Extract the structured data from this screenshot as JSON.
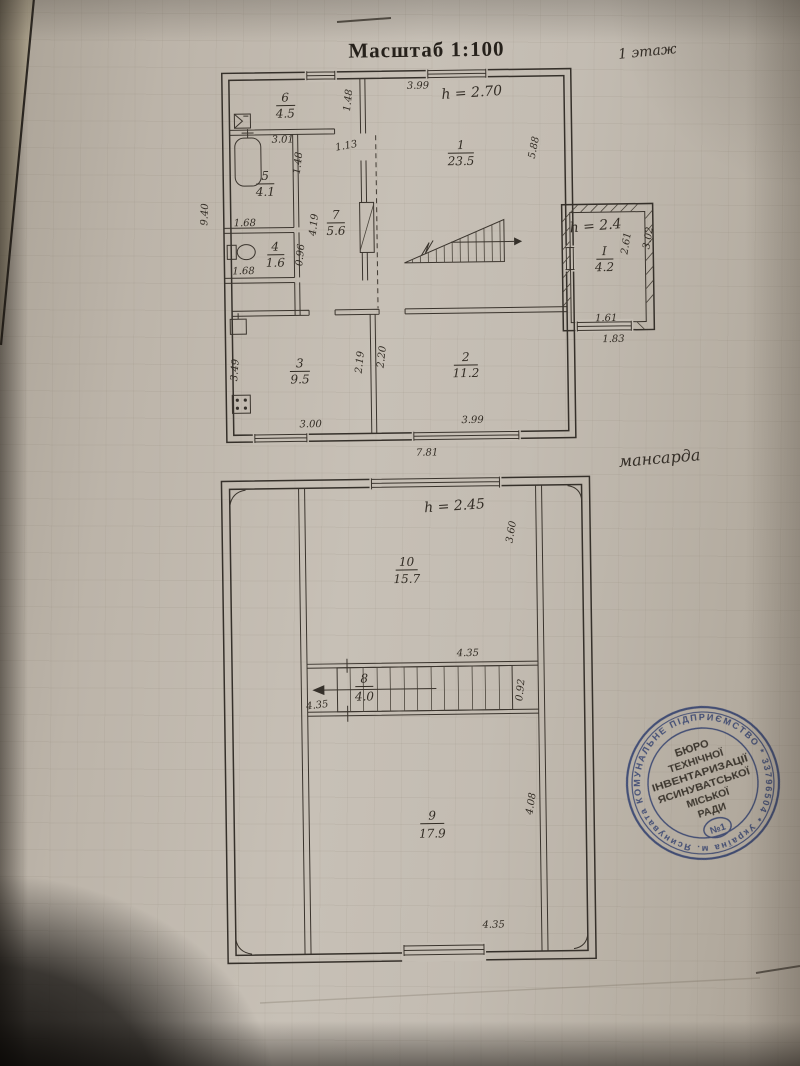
{
  "colors": {
    "paper": "#c1bab0",
    "ink": "#35302a",
    "stamp_blue": "#3c55a8"
  },
  "title": "Масштаб 1:100",
  "floor1": {
    "label": "1 этаж",
    "height_note": "h = 2.70",
    "rooms": {
      "r1": {
        "num": "1",
        "area": "23.5"
      },
      "r2": {
        "num": "2",
        "area": "11.2"
      },
      "r3": {
        "num": "3",
        "area": "9.5"
      },
      "r4": {
        "num": "4",
        "area": "1.6"
      },
      "r5": {
        "num": "5",
        "area": "4.1"
      },
      "r6": {
        "num": "6",
        "area": "4.5"
      },
      "r7": {
        "num": "7",
        "area": "5.6"
      }
    },
    "dims": {
      "left_total": "9.40",
      "top_301": "3.01",
      "top_399": "3.99",
      "w148a": "1.48",
      "w148b": "1.48",
      "w113": "1.13",
      "c419": "4.19",
      "wc_top": "1.68",
      "wc_bottom": "1.68",
      "wc_side": "0.96",
      "right_side": "5.88",
      "r3_h": "3.49",
      "r3_w": "3.00",
      "r2_h219": "2.19",
      "r2_h220": "2.20",
      "r2_w": "3.99",
      "total_w": "7.81"
    },
    "annex": {
      "num": "I",
      "area": "4.2",
      "height_note": "h = 2.4",
      "dims": {
        "inner_h": "2.61",
        "outer_h": "3.02",
        "inner_w": "1.61",
        "outer_w": "1.83"
      }
    }
  },
  "mansard": {
    "label": "мансарда",
    "height_note": "h = 2.45",
    "rooms": {
      "r10": {
        "num": "10",
        "area": "15.7"
      },
      "r8": {
        "num": "8",
        "area": "4.0"
      },
      "r9": {
        "num": "9",
        "area": "17.9"
      }
    },
    "dims": {
      "r10_h": "3.60",
      "r10_w": "4.35",
      "stair_left": "4.35",
      "stair_h": "0.92",
      "r9_h": "4.08",
      "r9_w": "4.35"
    }
  },
  "stamp": {
    "ring_text": "КОМУНАЛЬНЕ ПІДПРИЄМСТВО * 33796504 * Україна м. Ясинувата",
    "lines": [
      "БЮРО",
      "ТЕХНІЧНОЇ",
      "ІНВЕНТАРИЗАЦІЇ",
      "ЯСИНУВАТСЬКОЇ",
      "МІСЬКОЇ",
      "РАДИ"
    ],
    "number": "№1"
  }
}
